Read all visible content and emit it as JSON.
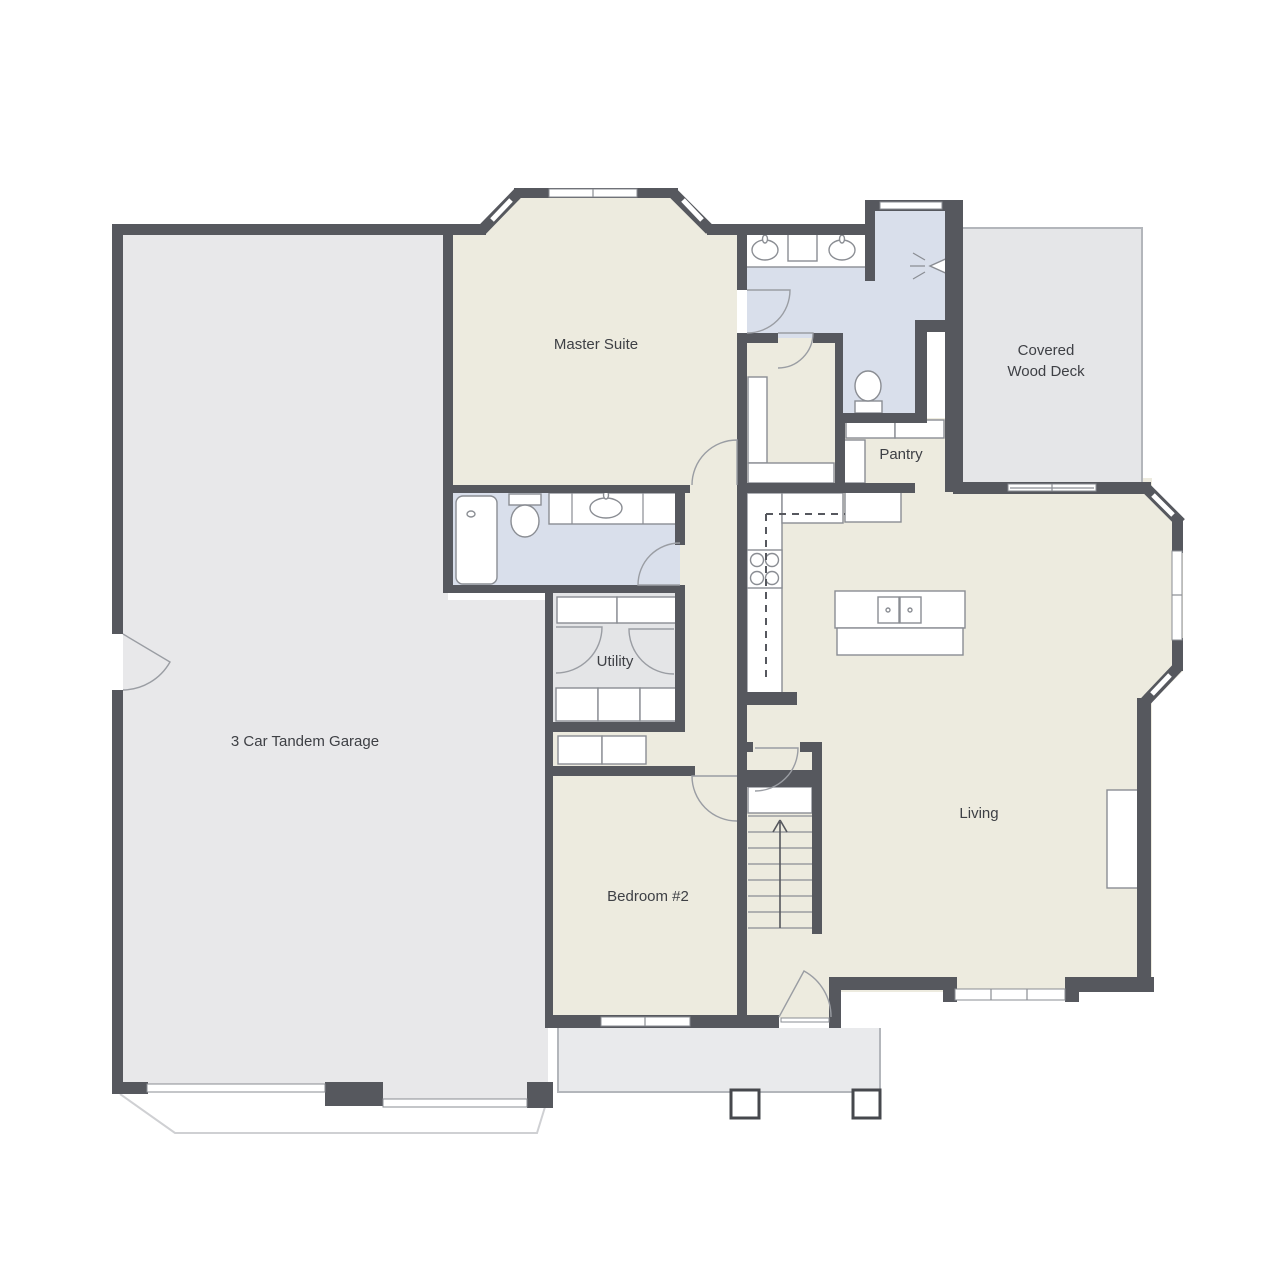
{
  "floor_plan": {
    "rooms": {
      "garage": {
        "label": "3 Car Tandem Garage"
      },
      "master_suite": {
        "label": "Master Suite"
      },
      "covered_wood_deck": {
        "label_line1": "Covered",
        "label_line2": "Wood Deck"
      },
      "pantry": {
        "label": "Pantry"
      },
      "utility": {
        "label": "Utility"
      },
      "bedroom_2": {
        "label": "Bedroom #2"
      },
      "living": {
        "label": "Living"
      }
    },
    "fixtures": [
      "bathtub",
      "toilet",
      "double-sink-vanity",
      "sink-vanity",
      "shower",
      "stove",
      "kitchen-island-sink",
      "pantry-shelves",
      "washer-dryer",
      "closet",
      "fireplace",
      "stairs-up",
      "porch-posts",
      "garage-doors"
    ],
    "colors": {
      "wall": "#56585e",
      "room": "#edebdf",
      "bath": "#d9dfeb",
      "garage": "#e8e8ea",
      "deck": "#e5e6e8",
      "porch": "#e9eaec",
      "utility": "#e4e5e7",
      "fixture_line": "#8a8d93",
      "door_line": "#9a9da3",
      "edge_line": "#b3b6bb",
      "apron": "#cfd0d3",
      "label": "#3e4045"
    }
  }
}
